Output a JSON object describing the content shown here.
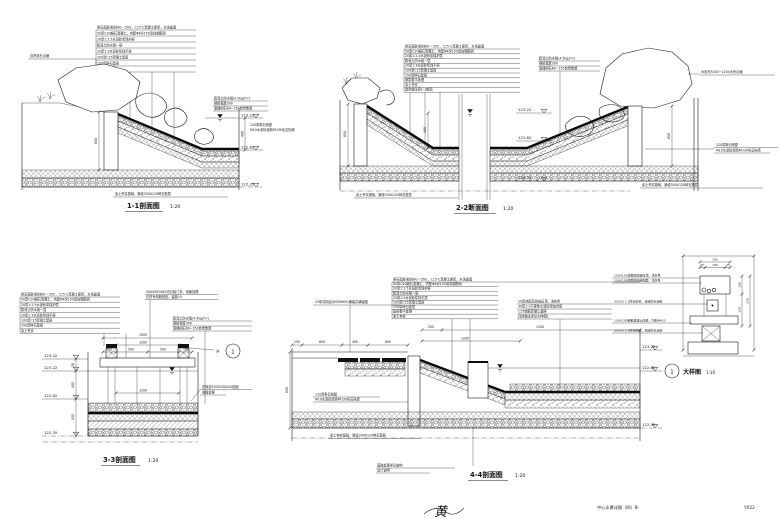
{
  "sheet": {
    "name": "中心水景详图（四）B-",
    "number": "YX22",
    "signature": "黄"
  },
  "common": {
    "wall_note1": "120厚条石侧壁",
    "wall_note2": "M10水泥砂浆砌MU30毛石挡墙",
    "base_note": "素土夯实基础，铺设300X120碎石垫层",
    "membrane": [
      "膨润土防水毯(4.5kg/m²)",
      "搭接宽度300",
      "面铺卵石60~150自然散置"
    ],
    "elev": {
      "e0": "123.42",
      "e1": "123.22",
      "e2": "122.82",
      "e3": "122.35"
    },
    "depth": "400",
    "wall_h": "850"
  },
  "s11": {
    "title": "1-1剖面图",
    "scale": "1:20",
    "rock_label": "自然景石点缀",
    "layers": [
      "卵石面层(粒径60~150)，C15-C混凝土座浆，水洗露面",
      "50厚C20细石混凝土，内配Φ4@150双向钢筋网",
      "20厚1:2.5水泥砂浆保护层",
      "膨润土防水毯一层",
      "20厚1:3水泥砂浆找平层",
      "100厚C15混凝土垫层",
      "150厚碎石垫层",
      "素土夯实"
    ]
  },
  "s22": {
    "title": "2-2断面图",
    "scale": "1:20",
    "rock_label": "水景石R300~1200大块点缀",
    "layers": [
      "卵石面层(粒径60~150)，C15-C混凝土座浆，水洗露面",
      "50厚C20细石混凝土，内配Φ4@150双向钢筋网",
      "20厚1:2.5水泥砂浆保护层",
      "膨润土防水毯一层",
      "20厚1:3水泥砂浆找平层",
      "100厚C15混凝土垫层",
      "150厚碎石垫层",
      "基层整平处理",
      "素土夯实",
      "其余做法同1-1剖面"
    ]
  },
  "s33": {
    "title": "3-3剖面图",
    "scale": "1:20",
    "step_note1": "500X500X80青石板汀步，烧面处理",
    "step_note2": "石材专用胶粘贴，留缝10",
    "pier_note1": "花岗岩500X300X20贴面",
    "pier_note2": "烧面处理",
    "callout_text": "详",
    "callout_num": "1",
    "layers": [
      "卵石面层(粒径60~150)，C15-C混凝土座浆，水洗露面",
      "50厚C20细石混凝土，内配Φ4@150双向钢筋网",
      "20厚1:2.5水泥砂浆保护层",
      "膨润土防水毯一层",
      "20厚1:3水泥砂浆找平层",
      "100厚C15混凝土垫层",
      "150厚碎石垫层",
      "素土夯实"
    ],
    "dims": {
      "total": "1500",
      "inner": "1200",
      "segs": [
        "150",
        "500",
        "500",
        "150"
      ],
      "v": [
        "50",
        "400",
        "450"
      ]
    }
  },
  "s44": {
    "title": "4-4剖面图",
    "scale": "1:20",
    "paving_note": "20厚花岗岩(600X600)铺装见铺装图",
    "layers": [
      "卵石面层(粒径60~150)，C15-C混凝土座浆，水洗露面",
      "50厚C20细石混凝土，内配Φ4@150双向钢筋网",
      "20厚1:2.5水泥砂浆保护层",
      "膨润土防水毯一层",
      "20厚1:3水泥砂浆找平层",
      "100厚C15混凝土垫层",
      "150厚碎石垫层",
      "基层整平处理",
      "素土夯实"
    ],
    "right_notes": [
      "20厚烧面花岗岩压顶，浅灰色",
      "30厚1:3干硬性水泥砂浆结合层",
      "C25钢筋混凝土基座",
      "具体做法详见大样图1"
    ],
    "foot_note1": "基础处理详见结构",
    "foot_note2": "设计说明",
    "dims": {
      "top": [
        "200",
        "1100",
        "1200"
      ],
      "left": [
        "150",
        "650",
        "400",
        "600"
      ]
    }
  },
  "detail": {
    "num": "1",
    "title": "大样图",
    "scale": "1:10",
    "leaders": [
      "150X100烧面花岗岩压顶，浅灰色",
      "100X100烧面花岗岩贴面，浅灰色",
      "30X20 1:2防水砂浆，满涂防水涂料",
      "100X100钢筋混凝土压梁，内配4Φ10",
      "20X20 1:2防水砂浆，满涂防水涂料"
    ],
    "dims": {
      "total": "150",
      "segs": [
        "25",
        "100",
        "25"
      ],
      "right": [
        "100",
        "150",
        "250"
      ]
    }
  }
}
